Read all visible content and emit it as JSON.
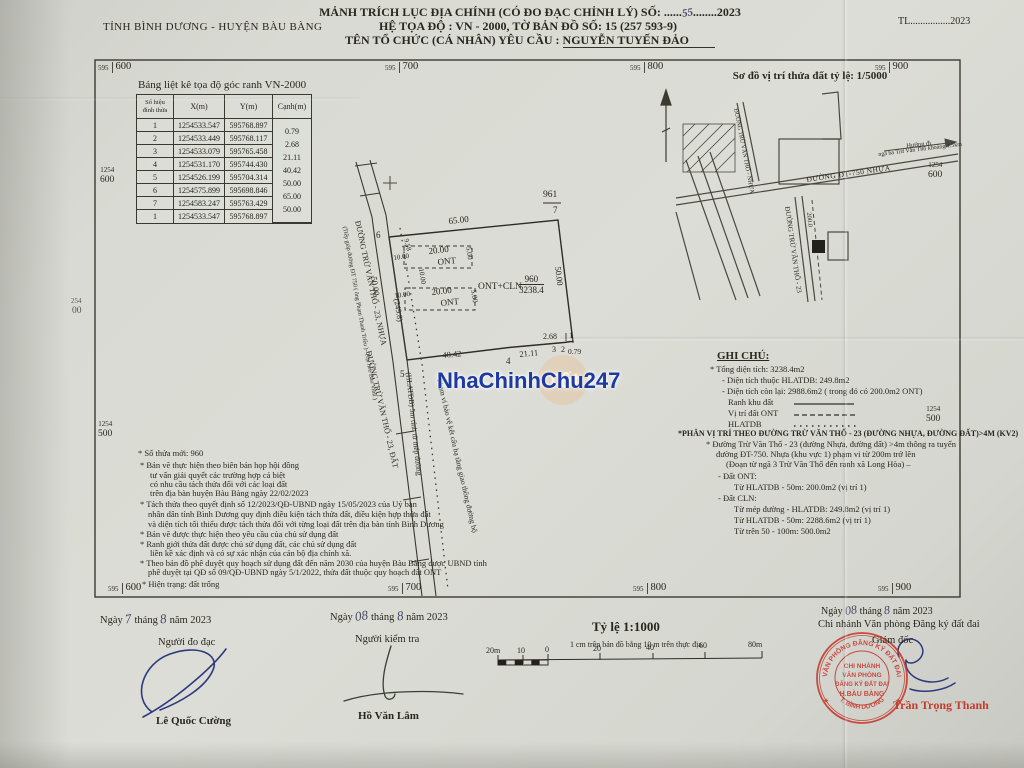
{
  "watermark": {
    "text": "NhaChinhChu247",
    "logo_text": "Tốt"
  },
  "header": {
    "province": "TỈNH BÌNH DƯƠNG - HUYỆN BÀU BÀNG",
    "title1_pre": "MẢNH TRÍCH LỤC ĐỊA CHÍNH (CÓ ĐO ĐẠC CHỈNH LÝ) SỐ: ......",
    "title1_no": "55",
    "title1_post": "........2023",
    "title2": "HỆ TỌA ĐỘ : VN - 2000, TỜ BẢN ĐỒ SỐ: 15 (257 593-9)",
    "title3_label": "TÊN TỔ CHỨC (CÁ NHÂN) YÊU CẦU : ",
    "title3_name": "NGUYỄN TUYẾN ĐẢO",
    "tl": "TL................2023"
  },
  "grid": {
    "t1s": "595",
    "t1b": "600",
    "t2s": "595",
    "t2b": "700",
    "t3s": "595",
    "t3b": "800",
    "t4s": "595",
    "t4b": "900",
    "b1s": "595",
    "b1b": "600",
    "b2s": "595",
    "b2b": "700",
    "b3s": "595",
    "b3b": "800",
    "b4s": "595",
    "b4b": "900",
    "l1a": "1254",
    "l1b": "600",
    "l2a": "1254",
    "l2b": "500",
    "r1a": "1254",
    "r1b": "600",
    "r2a": "1254",
    "r2b": "500",
    "edge_a": "254",
    "edge_b": "00"
  },
  "coord_table": {
    "title": "Bảng liệt kê tọa độ góc ranh VN-2000",
    "h_vertex1": "Số hiệu",
    "h_vertex2": "đỉnh thửa",
    "h_x": "X(m)",
    "h_y": "Y(m)",
    "h_edge": "Cạnh(m)",
    "rows": [
      {
        "v": "1",
        "x": "1254533.547",
        "y": "595768.897"
      },
      {
        "v": "2",
        "x": "1254533.449",
        "y": "595768.117"
      },
      {
        "v": "3",
        "x": "1254533.079",
        "y": "595765.458"
      },
      {
        "v": "4",
        "x": "1254531.170",
        "y": "595744.430"
      },
      {
        "v": "5",
        "x": "1254526.199",
        "y": "595704.314"
      },
      {
        "v": "6",
        "x": "1254575.899",
        "y": "595698.846"
      },
      {
        "v": "7",
        "x": "1254583.247",
        "y": "595763.429"
      },
      {
        "v": "1",
        "x": "1254533.547",
        "y": "595768.897"
      }
    ],
    "edges": [
      "0.79",
      "2.68",
      "21.11",
      "40.42",
      "50.00",
      "65.00",
      "50.00"
    ]
  },
  "sketch": {
    "title": "Sơ đồ vị trí thửa đất tỷ lệ: 1/5000",
    "road_main": "ĐƯỜNG ĐT-750 NHỰA",
    "road_branch": "ĐƯỜNG TRỪ VĂN THỐ - 23",
    "road_upper": "ĐƯỜNG TRỪ VĂN THỐ - NHỰA",
    "dir1": "Hướng đi",
    "dir2": "ngã ba Trừ Văn Thố khoảng 1.5km",
    "dist": "200.0"
  },
  "plot": {
    "neighbor": "961",
    "parcel_no": "960",
    "area": "3238.4",
    "use": "ONT+CLN",
    "dim_top": "65.00",
    "dim_right": "50.00",
    "dim_left": "50.00",
    "chainage": "(249.8)",
    "dim_b1": "40.42",
    "dim_b2": "21.11",
    "dim_b3": "2.68",
    "dim_b4": "0.79",
    "c1": "1",
    "c2": "2",
    "c3": "3",
    "c4": "4",
    "c5": "5",
    "c6": "6",
    "c7": "7",
    "sub_w": "20.00",
    "sub_h": "5.00",
    "sub_use": "ONT",
    "d958": "9.58",
    "d10": "10.00",
    "road1": "ĐƯỜNG TRỪ VĂN THỐ - 23, NHỰA",
    "road2": "ĐƯỜNG TRỪ VĂN THỐ - 23, ĐẤT",
    "road_note": "(Tiếp giáp đường ĐT 750 ( ông Phạm Thanh Triều )- Trại heo Bảo Vinh )",
    "hlatdb": "(HLATĐB) 5m tính từ mép đường",
    "corridor": "Phạm vi bảo vệ kết cấu hạ tầng giao thông đường bộ"
  },
  "notes_right": {
    "title": "GHI CHÚ:",
    "l1": "* Tổng diện tích: 3238.4m2",
    "l2": "- Diện tích thuộc HLATDB: 249.8m2",
    "l3": "- Diện tích còn lại: 2988.6m2 ( trong đó có 200.0m2 ONT)",
    "legend1": "Ranh khu đất",
    "legend2": "Vị trí đất ONT",
    "legend3": "HLATDB",
    "sec2": "*PHÂN VỊ TRÍ THEO ĐƯỜNG TRỪ VĂN THỐ - 23 (ĐƯỜNG NHỰA, ĐƯỜNG ĐẤT)>4M (KV2)",
    "l4": "* Đường Trừ Văn Thố - 23 (đường Nhựa, đường đất) >4m thông ra tuyến",
    "l5": "đường ĐT-750. Nhựa (khu vực 1) phạm vi từ 200m trở lên",
    "l6": "(Đoạn từ ngã 3 Trừ Văn Thố đến ranh xã Long Hòa) –",
    "l7": "- Đất ONT:",
    "l8": "Từ HLATDB - 50m: 200.0m2 (vị trí 1)",
    "l9": "- Đất CLN:",
    "l10": "Từ mép đường - HLATDB: 249.8m2 (vị trí 1)",
    "l11": "Từ HLATDB - 50m: 2288.6m2 (vị trí 1)",
    "l12": "Từ trên 50 - 100m: 500.0m2"
  },
  "notes_left": {
    "l1": "* Số thửa mới: 960",
    "l2": "* Bản vẽ thực hiện theo biên bản họp hội đồng",
    "l3": "tư vấn giải quyết các trường hợp  cá biệt",
    "l4": "có nhu cầu tách thửa đối với các loại đất",
    "l5": "trên địa bàn huyện Bàu Bàng ngày 22/02/2023",
    "l6": "* Tách thửa theo quyết định số 12/2023/QĐ-UBND ngày 15/05/2023 của Uỷ ban",
    "l7": "nhân dân tỉnh Bình Dương quy định điều kiện tách thửa đất, điều kiện hợp thửa đất",
    "l8": "và diện tích tối thiểu được tách thửa đối với từng loại đất trên địa bàn tỉnh Bình Dương",
    "l9": "* Bản vẽ được thực hiện theo yêu cầu của chủ sử dụng đất",
    "l10": "* Ranh giới thửa đất được chủ sử dụng đất, các chủ sử dụng đất",
    "l11": "liền kề xác định và có sự xác nhận của cán bộ địa chính xã.",
    "l12": "* Theo bản đồ phê duyệt quy hoạch sử dụng đất đến năm 2030 của huyện Bàu Bàng được UBND tỉnh",
    "l13": "phê duyệt tại QĐ số 09/QĐ-UBND ngày 5/1/2022, thửa đất thuộc quy hoạch đất ONT",
    "l14": "* Hiện trạng: đất trống"
  },
  "footer": {
    "ngay": "Ngày",
    "thang": "tháng",
    "nam": "năm 2023",
    "left_d": "7",
    "left_m": "8",
    "left_role": "Người đo đạc",
    "left_name": "Lê Quốc Cường",
    "mid_d": "08",
    "mid_m": "8",
    "mid_role": "Người kiểm tra",
    "mid_name": "Hồ Văn Lâm",
    "scale_title": "Tỷ lệ 1:1000",
    "scale_note": "1 cm trên bản đồ bằng 10 m trên thực địa",
    "sb1": "20m",
    "sb2": "10",
    "sb3": "0",
    "sb4": "20",
    "sb5": "40",
    "sb6": "60",
    "sb7": "80m",
    "right_d": "08",
    "right_m": "8",
    "right_org": "Chi nhánh Văn phòng Đăng ký đất đai",
    "right_role": "Giám đốc",
    "right_name": "Trần Trọng Thanh"
  },
  "stamp": {
    "ring_top": "VĂN PHÒNG ĐĂNG KÝ ĐẤT ĐAI",
    "ring_bottom": "T. BÌNH DƯƠNG",
    "star": "★",
    "c1": "CHI NHÁNH",
    "c2": "VĂN PHÒNG",
    "c3": "ĐĂNG KÝ ĐẤT ĐAI",
    "c4": "H.BÀU BÀNG"
  }
}
